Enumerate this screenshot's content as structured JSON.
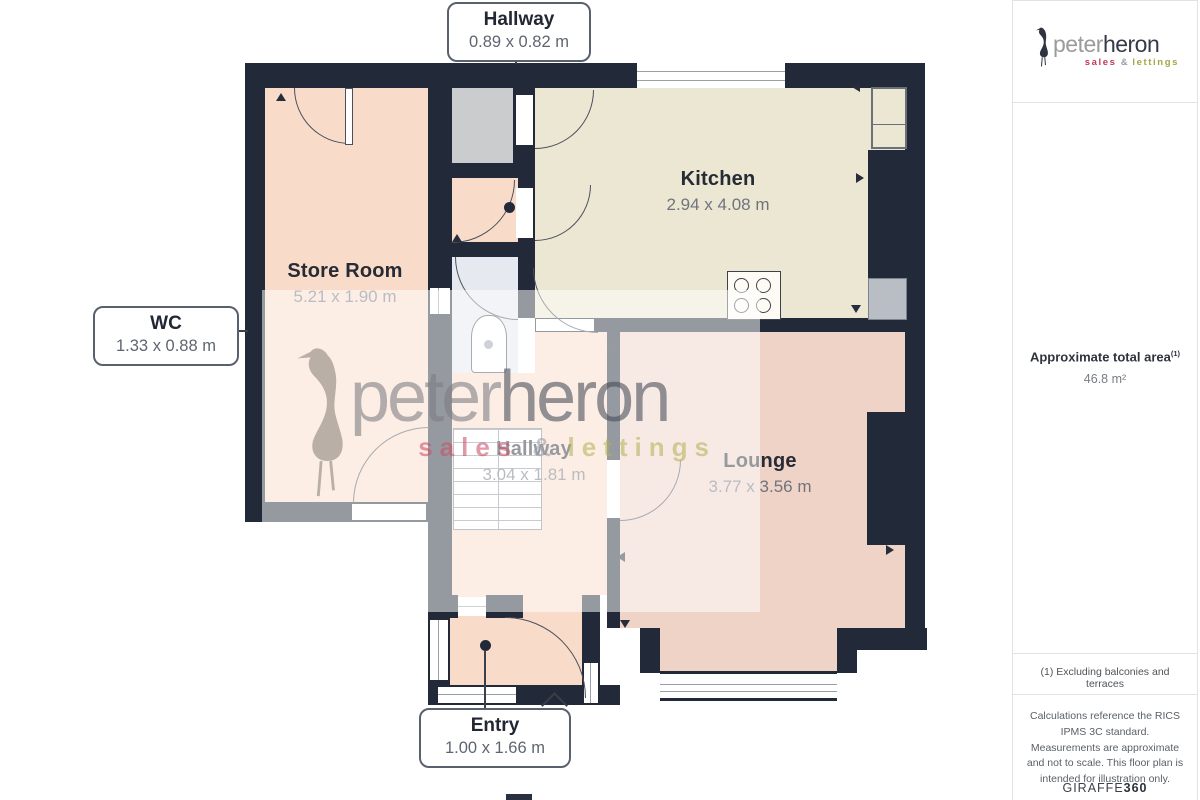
{
  "floorplan": {
    "colors": {
      "wall": "#222a3a",
      "store_floor": "#f8dcc9",
      "kitchen_floor": "#ece7d2",
      "lounge_floor": "#eed3c6",
      "bath_floor": "#e7e9f1",
      "cupboard_floor": "#cbccce"
    },
    "rooms": {
      "kitchen": {
        "name": "Kitchen",
        "dims": "2.94 x 4.08 m"
      },
      "store_room": {
        "name": "Store Room",
        "dims": "5.21 x 1.90 m"
      },
      "lounge": {
        "name": "Lounge",
        "dims": "3.77 x 3.56 m"
      },
      "hallway": {
        "name": "Hallway",
        "dims": "3.04 x 1.81 m"
      }
    },
    "callouts": {
      "hallway_top": {
        "name": "Hallway",
        "dims": "0.89 x 0.82 m"
      },
      "wc": {
        "name": "WC",
        "dims": "1.33 x 0.88 m"
      },
      "entry": {
        "name": "Entry",
        "dims": "1.00 x 1.66 m"
      }
    }
  },
  "watermark": {
    "brand_first": "peter",
    "brand_second": "heron",
    "tagline": {
      "sales": "sales",
      "amp": "&",
      "lettings": "lettings"
    }
  },
  "sidebar": {
    "logo": {
      "brand_first": "peter",
      "brand_second": "heron",
      "tagline": {
        "sales": "sales",
        "amp": "&",
        "lettings": "lettings"
      }
    },
    "area": {
      "label": "Approximate total area",
      "superscript": "(1)",
      "value": "46.8 m²"
    },
    "footnote": "(1) Excluding balconies and terraces",
    "disclaimer": "Calculations reference the RICS IPMS 3C standard. Measurements are approximate and not to scale. This floor plan is intended for illustration only.",
    "credit": {
      "brand": "GIRAFFE",
      "suffix": "360"
    }
  }
}
